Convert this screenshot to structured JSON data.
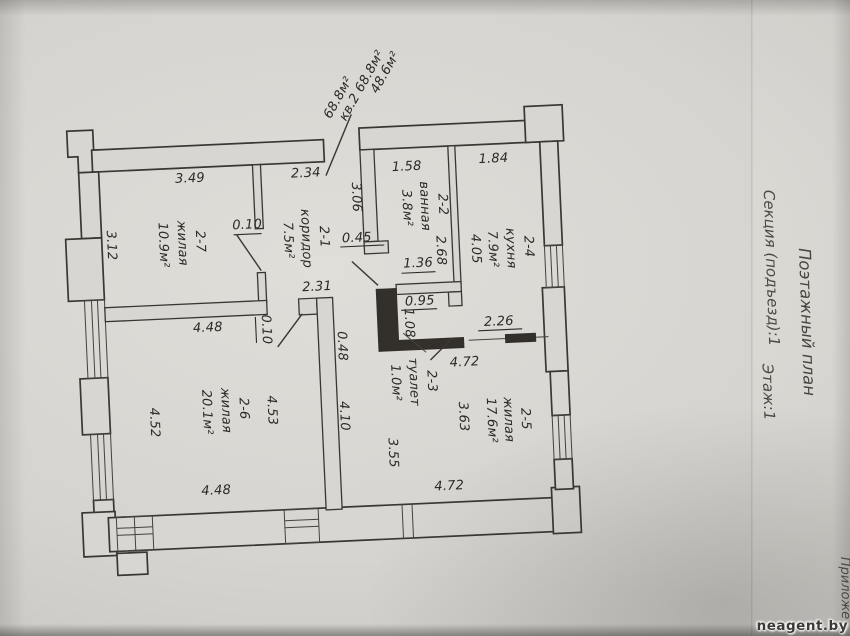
{
  "document": {
    "watermark": "neagent.by",
    "margin": {
      "plan_title": "Поэтажный план",
      "section_line": "Секция (подъезд):1",
      "floor_line": "Этаж:1",
      "attachment": "Приложе"
    },
    "apartment_annotations": {
      "line1": "48.6м²",
      "line2": "кв.2 68.8м²",
      "line3": "68.8м²"
    }
  },
  "rooms": [
    {
      "code": "2-1",
      "name": "коридор",
      "area": "7.5м²"
    },
    {
      "code": "2-2",
      "name": "ванная",
      "area": "3.8м²"
    },
    {
      "code": "2-3",
      "name": "туалет",
      "area": "1.0м²"
    },
    {
      "code": "2-4",
      "name": "кухня",
      "area": "7.9м²"
    },
    {
      "code": "2-5",
      "name": "жилая",
      "area": "17.6м²"
    },
    {
      "code": "2-6",
      "name": "жилая",
      "area": "20.1м²"
    },
    {
      "code": "2-7",
      "name": "жилая",
      "area": "10.9м²"
    }
  ],
  "dims": {
    "room27_top": "3.49",
    "room27_left": "3.12",
    "room27_bottom": "4.48",
    "door27": "0.10",
    "corridor_top": "2.34",
    "corridor_height": "3.06",
    "corridor_width": "2.31",
    "niche": "0.45",
    "closet": "1.36",
    "bath_top": "1.58",
    "bath_height": "2.68",
    "kitchen_top": "1.84",
    "kitchen_height": "4.05",
    "kitchen_opening": "2.26",
    "toilet_width": "0.95",
    "toilet_height": "1.08",
    "room25_top": "4.72",
    "room25_right": "3.63",
    "room25_mid": "3.55",
    "room25_left": "4.10",
    "room25_stub": "0.48",
    "room25_bottom": "4.72",
    "room26_right": "4.53",
    "room26_left": "4.52",
    "room26_bottom": "4.48",
    "door26": "0.10"
  }
}
